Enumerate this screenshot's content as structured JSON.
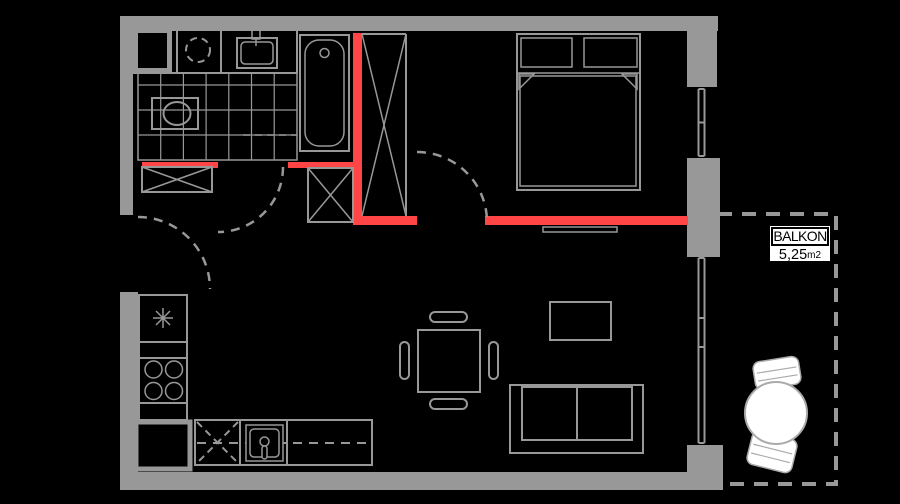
{
  "balcony_label": {
    "title": "BALKON",
    "area_value": "5,25",
    "area_unit": "m2"
  },
  "colors": {
    "background": "#000000",
    "wall": "#989898",
    "accent": "#ff4545",
    "balcony_furniture": "#ffffff",
    "label_bg": "#ffffff",
    "label_text": "#000000"
  },
  "icons": {
    "washing-machine-icon": "dashed circle",
    "bathroom-sink-icon": "rect with faucet",
    "bathtub-icon": "rounded rect with drain circle",
    "toilet-icon": "rect with ellipse",
    "wardrobe-x-icon": "rect with X",
    "shaft-x-icon": "tall rect with X",
    "door-swing-icon": "dashed quarter arc",
    "bed-icon": "rect with two pillows and duvet",
    "radiator-icon": "thin rect",
    "window-icon": "double parallel lines",
    "fridge-icon": "square with snowflake asterisk",
    "stove-icon": "square with four burner circles",
    "dishwasher-icon": "square with dashed X",
    "kitchen-sink-icon": "square with basin and faucet",
    "dining-table-icon": "square with four chair capsules",
    "coffee-table-icon": "rect",
    "sofa-icon": "rect with two seat cushions",
    "balcony-table-icon": "white circle",
    "balcony-chair-icon": "white rounded rect",
    "balcony-outline-icon": "dashed rectangle"
  }
}
